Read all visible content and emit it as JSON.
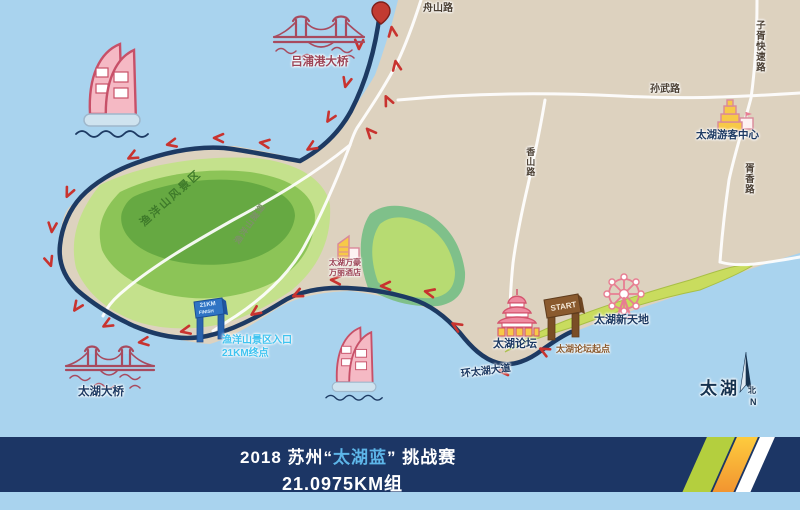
{
  "banner": {
    "p1": "2018 苏州“",
    "p2": "太湖蓝",
    "p3": "” 挑战赛",
    "line2": "21.0975KM组",
    "bg_color": "#1c3665",
    "accent_color": "#5db5e8"
  },
  "labels": {
    "zhoushan_road": "舟山路",
    "zixu_expressway": "子胥快速路",
    "sunwu_road": "孙武路",
    "visitor_center": "太湖游客中心",
    "xuxiang_road": "胥香路",
    "xiangshan_road": "香山路",
    "lupugang_bridge": "吕浦港大桥",
    "yuyangshan_scenic": "渔洋山风景区",
    "yuyangshan_tunnel": "渔洋山隧道",
    "hotel_line1": "太湖万豪",
    "hotel_line2": "万丽酒店",
    "finish_line1": "渔洋山景区入口",
    "finish_line2": "21KM终点",
    "taihu_bridge": "太湖大桥",
    "taihu_forum": "太湖论坛",
    "forum_start": "太湖论坛起点",
    "taihu_xintiandi": "太湖新天地",
    "huantaihu_avenue": "环太湖大道",
    "lake_name": "太湖",
    "compass_cn": "北",
    "compass_en": "N"
  },
  "gates": {
    "start": "START",
    "finish_top": "21KM",
    "finish_bottom": "FINISH"
  },
  "colors": {
    "water": "#a9d3ee",
    "land": "#ddd2bf",
    "green_light": "#c4e18c",
    "green_mid": "#8cc457",
    "green_dark": "#5fa53e",
    "coast_strip_green": "#c9dc5e",
    "route": "#1d3a63",
    "arrow_red": "#c8332f",
    "road_white": "#ffffff",
    "icon_pink": "#d4556e",
    "icon_maroon": "#a84a5e",
    "icon_yellow": "#f7c948",
    "start_gate_brown": "#8a5a2e",
    "finish_gate_blue": "#2f74c4"
  },
  "icons": [
    "location-pin-icon",
    "suspension-bridge-icon",
    "cable-bridge-icon",
    "sail-hotel-icon",
    "visitor-center-icon",
    "hotel-icon",
    "temple-icon",
    "ferris-wheel-icon",
    "start-gate-icon",
    "finish-gate-icon",
    "north-compass-icon"
  ]
}
